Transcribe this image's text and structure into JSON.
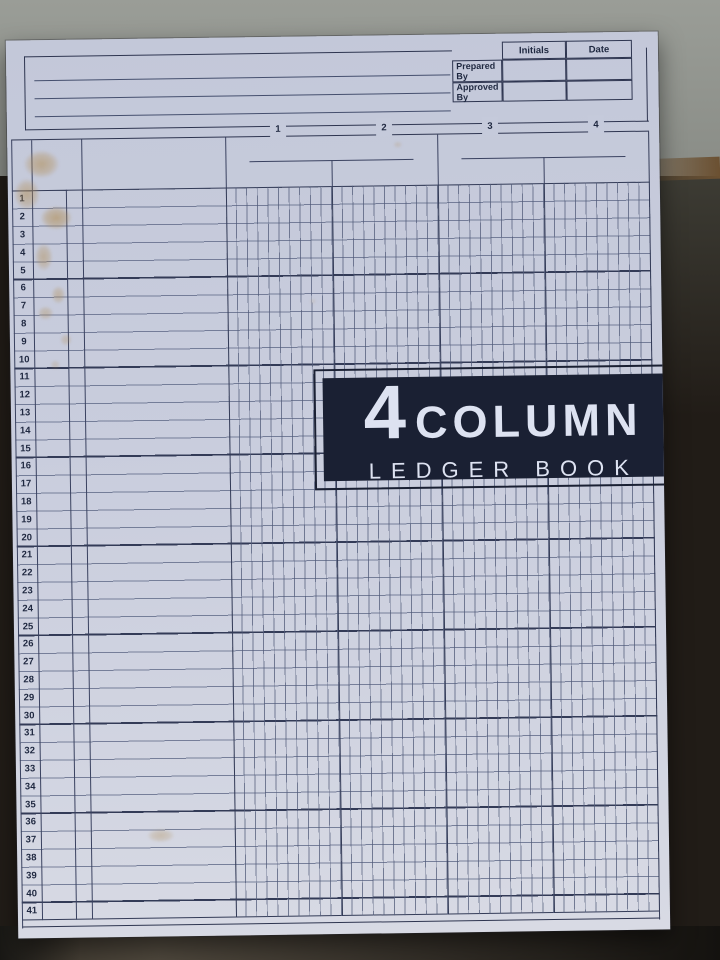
{
  "approval_table": {
    "headers": [
      "Initials",
      "Date"
    ],
    "row_labels": [
      "Prepared By",
      "Approved By"
    ]
  },
  "ledger": {
    "column_labels": [
      "1",
      "2",
      "3",
      "4"
    ],
    "row_numbers": [
      "1",
      "2",
      "3",
      "4",
      "5",
      "6",
      "7",
      "8",
      "9",
      "10",
      "11",
      "12",
      "13",
      "14",
      "15",
      "16",
      "17",
      "18",
      "19",
      "20",
      "21",
      "22",
      "23",
      "24",
      "25",
      "26",
      "27",
      "28",
      "29",
      "30",
      "31",
      "32",
      "33",
      "34",
      "35",
      "36",
      "37",
      "38",
      "39",
      "40",
      "41"
    ]
  },
  "banner": {
    "number": "4",
    "word": "COLUMN",
    "subtitle": "LEDGER BOOK"
  },
  "colors": {
    "banner_bg": "#1a2033",
    "banner_text": "#dde2f1",
    "paper": "#c9cddd",
    "grid_line_thick": "#2e3550",
    "grid_line_thin": "#5f6a8c",
    "stain": "#b08a4d",
    "background_concrete": "#90938d",
    "background_dark": "#211c17",
    "background_brown": "#6b5031"
  }
}
